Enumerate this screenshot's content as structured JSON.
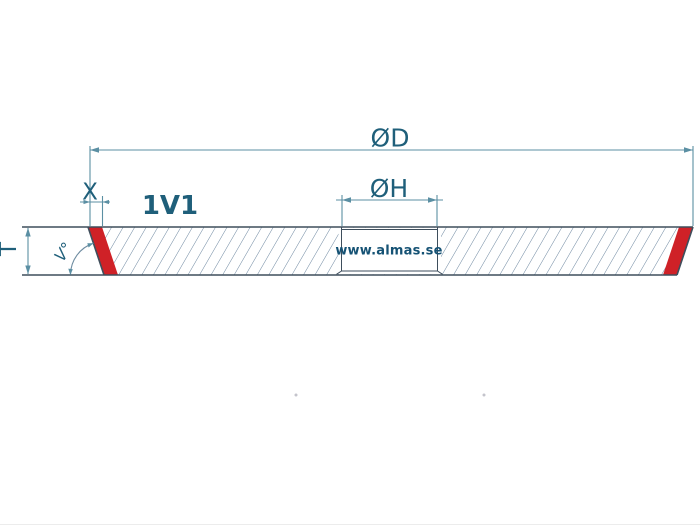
{
  "page": {
    "background": "#ffffff"
  },
  "colors": {
    "accent_red": "#cf2127",
    "dimension_line": "#5b8fa3",
    "outline": "#3e4e5c",
    "hatch": "#6d87a0",
    "label_text": "#1f5f7a",
    "watermark_text": "#155274",
    "dot": "#c4c4cc"
  },
  "drawing": {
    "profile_code": "1V1",
    "watermark": "www.almas.se",
    "dimensions": {
      "outer_diameter": {
        "label": "ØD"
      },
      "hole_diameter": {
        "label": "ØH"
      },
      "rim_width": {
        "label": "X"
      },
      "thickness": {
        "label": "T"
      },
      "rim_angle": {
        "label": "V°"
      }
    }
  }
}
